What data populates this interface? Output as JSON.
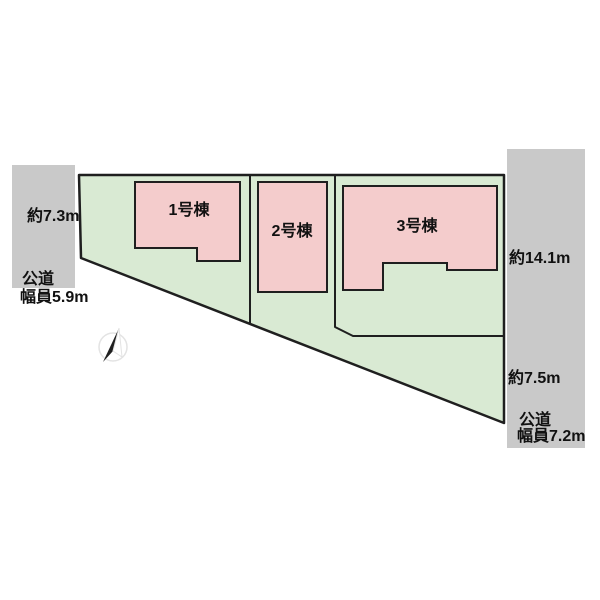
{
  "site_plan": {
    "buildings": [
      {
        "label": "1号棟"
      },
      {
        "label": "2号棟"
      },
      {
        "label": "3号棟"
      }
    ],
    "left_road": {
      "frontage": "約7.3m",
      "type": "公道",
      "width": "幅員5.9m"
    },
    "right_road": {
      "frontage_upper": "約14.1m",
      "frontage_lower": "約7.5m",
      "type": "公道",
      "width": "幅員7.2m"
    },
    "compass": "north"
  },
  "colors": {
    "lot_fill": "#d9ead3",
    "building_fill": "#f4cccc",
    "road_fill": "#c9c9c9",
    "outline": "#1f1f1f",
    "text": "#111111",
    "compass_ring": "#e3e3e3"
  }
}
